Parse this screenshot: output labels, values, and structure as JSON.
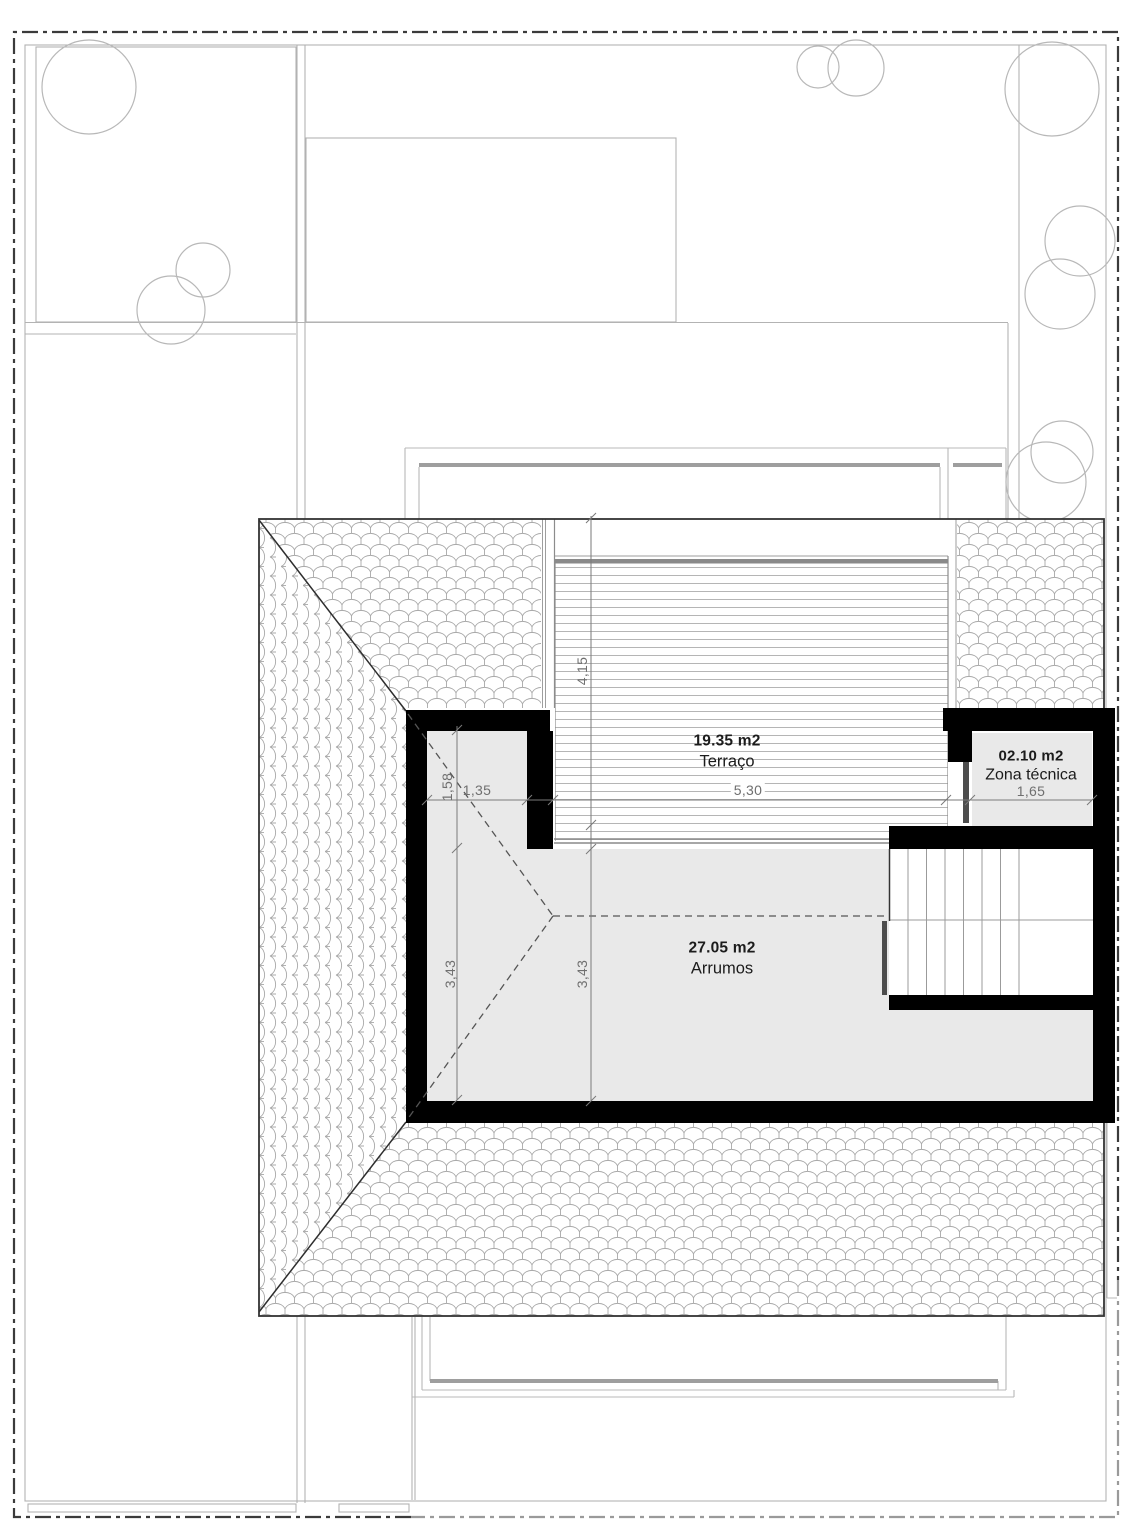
{
  "plan": {
    "rooms": [
      {
        "area": "19.35 m2",
        "name": "Terraço"
      },
      {
        "area": "02.10 m2",
        "name": "Zona técnica"
      },
      {
        "area": "27.05 m2",
        "name": "Arrumos"
      }
    ],
    "dimensions": {
      "terrace_depth": "4,15",
      "terrace_width": "5,30",
      "nook_width": "1,35",
      "nook_depth": "1,58",
      "zona_tecnica_width": "1,65",
      "storage_depth_left": "3,43",
      "storage_depth_center": "3,43"
    },
    "colors": {
      "wall_black": "#000000",
      "room_fill": "#e9e9e9",
      "tile_line": "#a8a8a8",
      "dimension_gray": "#6f6f6f",
      "label_dark": "#1c1c1c",
      "boundary_dark": "#3b3b3b",
      "boundary_light": "#9a9a9a"
    }
  }
}
